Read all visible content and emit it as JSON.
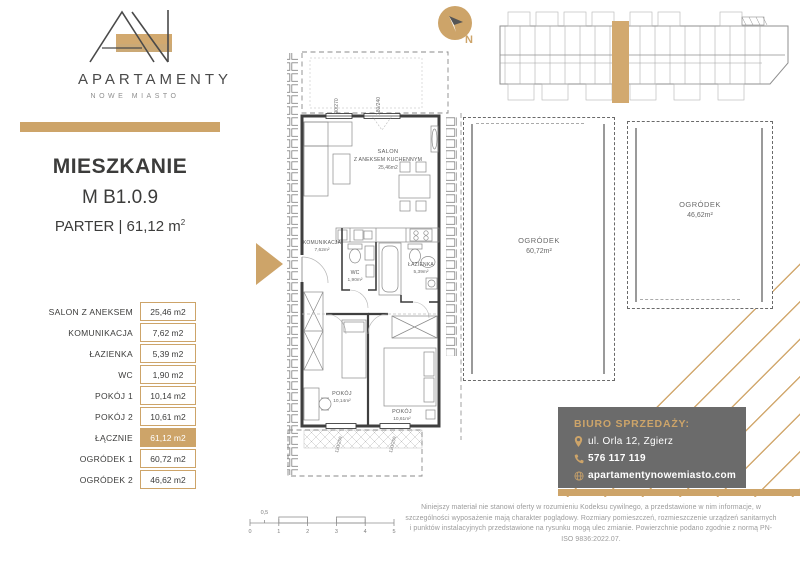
{
  "colors": {
    "gold": "#cda469",
    "dark_text": "#3c3c3b",
    "plan_wall": "#3f3f3f",
    "furniture_line": "#8a8a8a",
    "contact_bg": "#6b6b6b",
    "muted_text": "#9b9b9b"
  },
  "brand": {
    "name": "APARTAMENTY",
    "subtitle": "NOWE MIASTO"
  },
  "title": {
    "line1": "MIESZKANIE",
    "line2": "M B1.0.9",
    "line3": "PARTER | 61,12 m",
    "area_sup": "2"
  },
  "rooms": [
    {
      "label": "SALON Z ANEKSEM",
      "value": "25,46 m2"
    },
    {
      "label": "KOMUNIKACJA",
      "value": "7,62 m2"
    },
    {
      "label": "ŁAZIENKA",
      "value": "5,39 m2"
    },
    {
      "label": "WC",
      "value": "1,90 m2"
    },
    {
      "label": "POKÓJ 1",
      "value": "10,14 m2"
    },
    {
      "label": "POKÓJ 2",
      "value": "10,61 m2"
    },
    {
      "label": "ŁĄCZNIE",
      "value": "61,12 m2"
    },
    {
      "label": "OGRÓDEK 1",
      "value": "60,72 m2"
    },
    {
      "label": "OGRÓDEK 2",
      "value": "46,62 m2"
    }
  ],
  "plan": {
    "salon": {
      "name_l1": "SALON",
      "name_l2": "Z ANEKSEM KUCHENNYM",
      "area": "25,46m2"
    },
    "komunikacja": {
      "name": "KOMUNIKACJA",
      "area": "7,62m²"
    },
    "wc": {
      "name": "WC",
      "area": "1,90m²"
    },
    "lazienka": {
      "name": "ŁAZIENKA",
      "area": "5,39m²"
    },
    "pokoj1": {
      "name": "POKÓJ",
      "area": "10,14m²"
    },
    "pokoj2": {
      "name": "POKÓJ",
      "area": "10,61m²"
    },
    "windows": {
      "top1": "90/270",
      "top2": "180/240",
      "bottom1": "120/250",
      "bottom2": "120/250"
    }
  },
  "compass": {
    "label": "N"
  },
  "gardens": [
    {
      "name": "OGRÓDEK",
      "area": "60,72m²"
    },
    {
      "name": "OGRÓDEK",
      "area": "46,62m²"
    }
  ],
  "contact": {
    "heading": "BIURO SPRZEDAŻY:",
    "address": "ul. Orla 12, Zgierz",
    "phone": "576 117 119",
    "website": "apartamentynowemiasto.com"
  },
  "disclaimer": "Niniejszy materiał nie stanowi oferty w rozumieniu Kodeksu cywilnego, a przedstawione w nim informacje, w szczególności wyposażenie mają charakter poglądowy. Rozmiary pomieszczeń, rozmieszczenie urządzeń sanitarnych i punktów instalacyjnych przedstawione na rysunku mogą ulec zmianie. Powierzchnie podano zgodnie z normą PN-ISO 9836:2022.07.",
  "scalebar": {
    "labels": [
      "0",
      "1",
      "2",
      "3",
      "4",
      "5"
    ],
    "half_label": "0,5"
  }
}
